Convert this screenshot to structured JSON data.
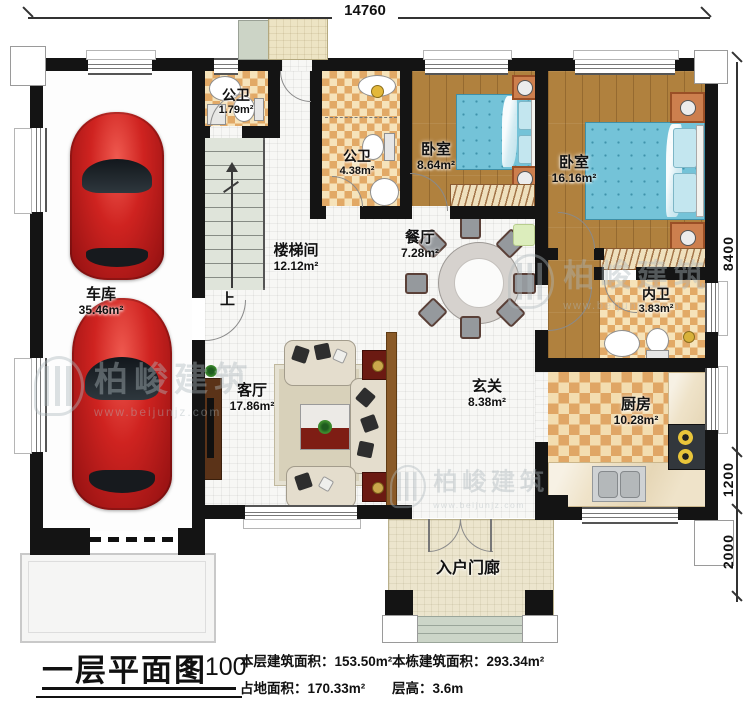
{
  "plan": {
    "up_label": "上"
  },
  "dims": {
    "top": "14760",
    "right": [
      "8400",
      "1200",
      "2000"
    ]
  },
  "rooms": {
    "garage": {
      "name": "车库",
      "area": "35.46m²"
    },
    "bath1": {
      "name": "公卫",
      "area": "1.79m²"
    },
    "bath2": {
      "name": "公卫",
      "area": "4.38m²"
    },
    "bedroom1": {
      "name": "卧室",
      "area": "8.64m²"
    },
    "bedroom2": {
      "name": "卧室",
      "area": "16.16m²"
    },
    "stairwell": {
      "name": "楼梯间",
      "area": "12.12m²"
    },
    "dining": {
      "name": "餐厅",
      "area": "7.28m²"
    },
    "ensuite": {
      "name": "内卫",
      "area": "3.83m²"
    },
    "kitchen": {
      "name": "厨房",
      "area": "10.28m²"
    },
    "living": {
      "name": "客厅",
      "area": "17.86m²"
    },
    "foyer": {
      "name": "玄关",
      "area": "8.38m²"
    },
    "porch": {
      "name": "入户门廊"
    }
  },
  "watermark": {
    "brand": "柏峻建筑",
    "url": "www.beijunjz.com"
  },
  "title_block": {
    "title": "一层平面图",
    "scale": "1:100",
    "stats": [
      "本层建筑面积：153.50m²",
      "占地面积：170.33m²",
      "本栋建筑面积：293.34m²",
      "层高：3.6m"
    ]
  }
}
